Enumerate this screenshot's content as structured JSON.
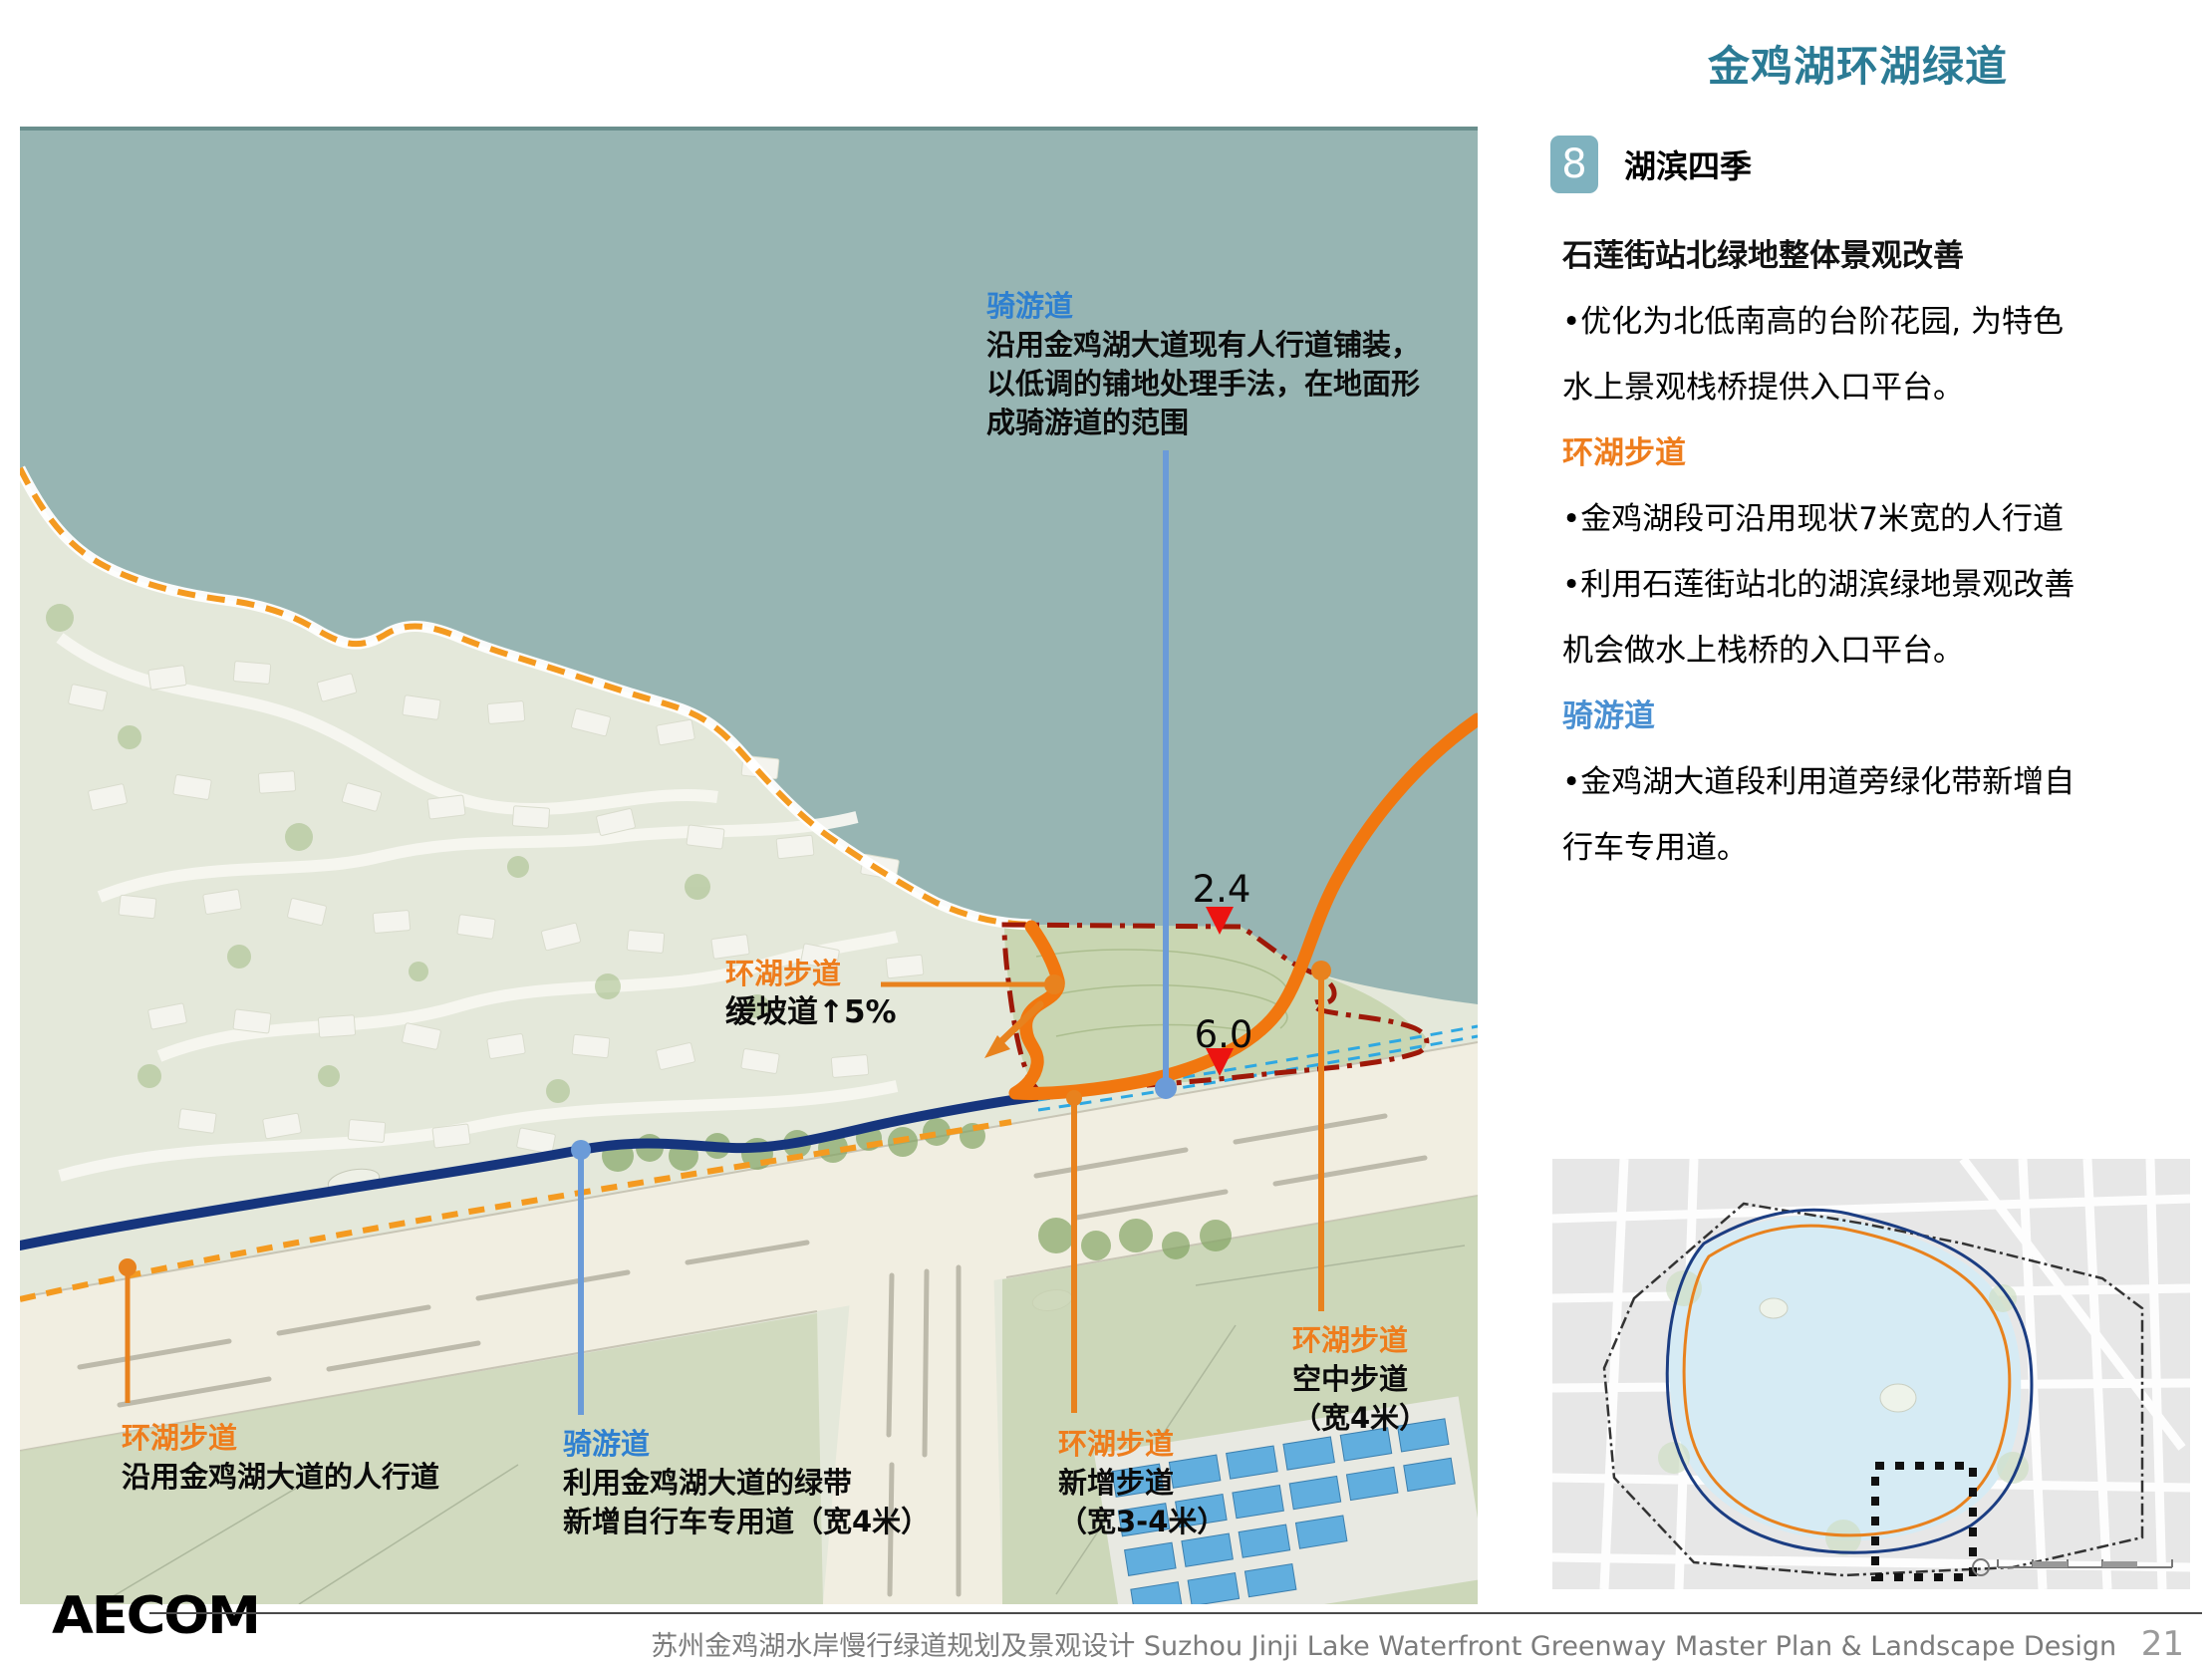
{
  "page": {
    "title": "金鸡湖环湖绿道",
    "logo_text": "AECOM",
    "footer_zh": "苏州金鸡湖水岸慢行绿道规划及景观设计",
    "footer_en": "Suzhou Jinji Lake Waterfront Greenway  Master Plan & Landscape Design",
    "page_number": "21"
  },
  "panel": {
    "badge_number": "8",
    "badge_title": "湖滨四季",
    "subtitle": "石莲街站北绿地整体景观改善",
    "paragraph1": [
      "•优化为北低南高的台阶花园, 为特色",
      "水上景观栈桥提供入口平台。"
    ],
    "heading_walk": "环湖步道",
    "paragraph2": [
      "•金鸡湖段可沿用现状7米宽的人行道",
      "•利用石莲街站北的湖滨绿地景观改善",
      "机会做水上栈桥的入口平台。"
    ],
    "heading_bike": "骑游道",
    "paragraph3": [
      "•金鸡湖大道段利用道旁绿化带新增自",
      "行车专用道。"
    ]
  },
  "annotations": {
    "bike_top": {
      "title": "骑游道",
      "lines": [
        "沿用金鸡湖大道现有人行道铺装，",
        "以低调的铺地处理手法，在地面形",
        "成骑游道的范围"
      ]
    },
    "ramp": {
      "title": "环湖步道",
      "subtitle": "缓坡道↑5%"
    },
    "dim_shore": "2.4",
    "dim_road": "6.0",
    "walk_existing": {
      "title": "环湖步道",
      "lines": [
        "沿用金鸡湖大道的人行道"
      ]
    },
    "bike_lane": {
      "title": "骑游道",
      "lines": [
        "利用金鸡湖大道的绿带",
        "新增自行车专用道（宽4米）"
      ]
    },
    "walk_new": {
      "title": "环湖步道",
      "lines": [
        "新增步道",
        "（宽3-4米）"
      ]
    },
    "walk_sky": {
      "title": "环湖步道",
      "lines": [
        "空中步道",
        "（宽4米）"
      ]
    }
  },
  "colors": {
    "accent_teal": "#2b7b95",
    "orange_label": "#ee7d1d",
    "route_orange": "#f1770f",
    "dashed_orange": "#f49a20",
    "blue_label": "#2f80d0",
    "leader_blue": "#6b9bd8",
    "navy_route": "#16357d",
    "boundary_red": "#9e1808",
    "marker_red": "#ec1310",
    "cyan_dash": "#2fa8e1",
    "water": "#97b5b3"
  }
}
